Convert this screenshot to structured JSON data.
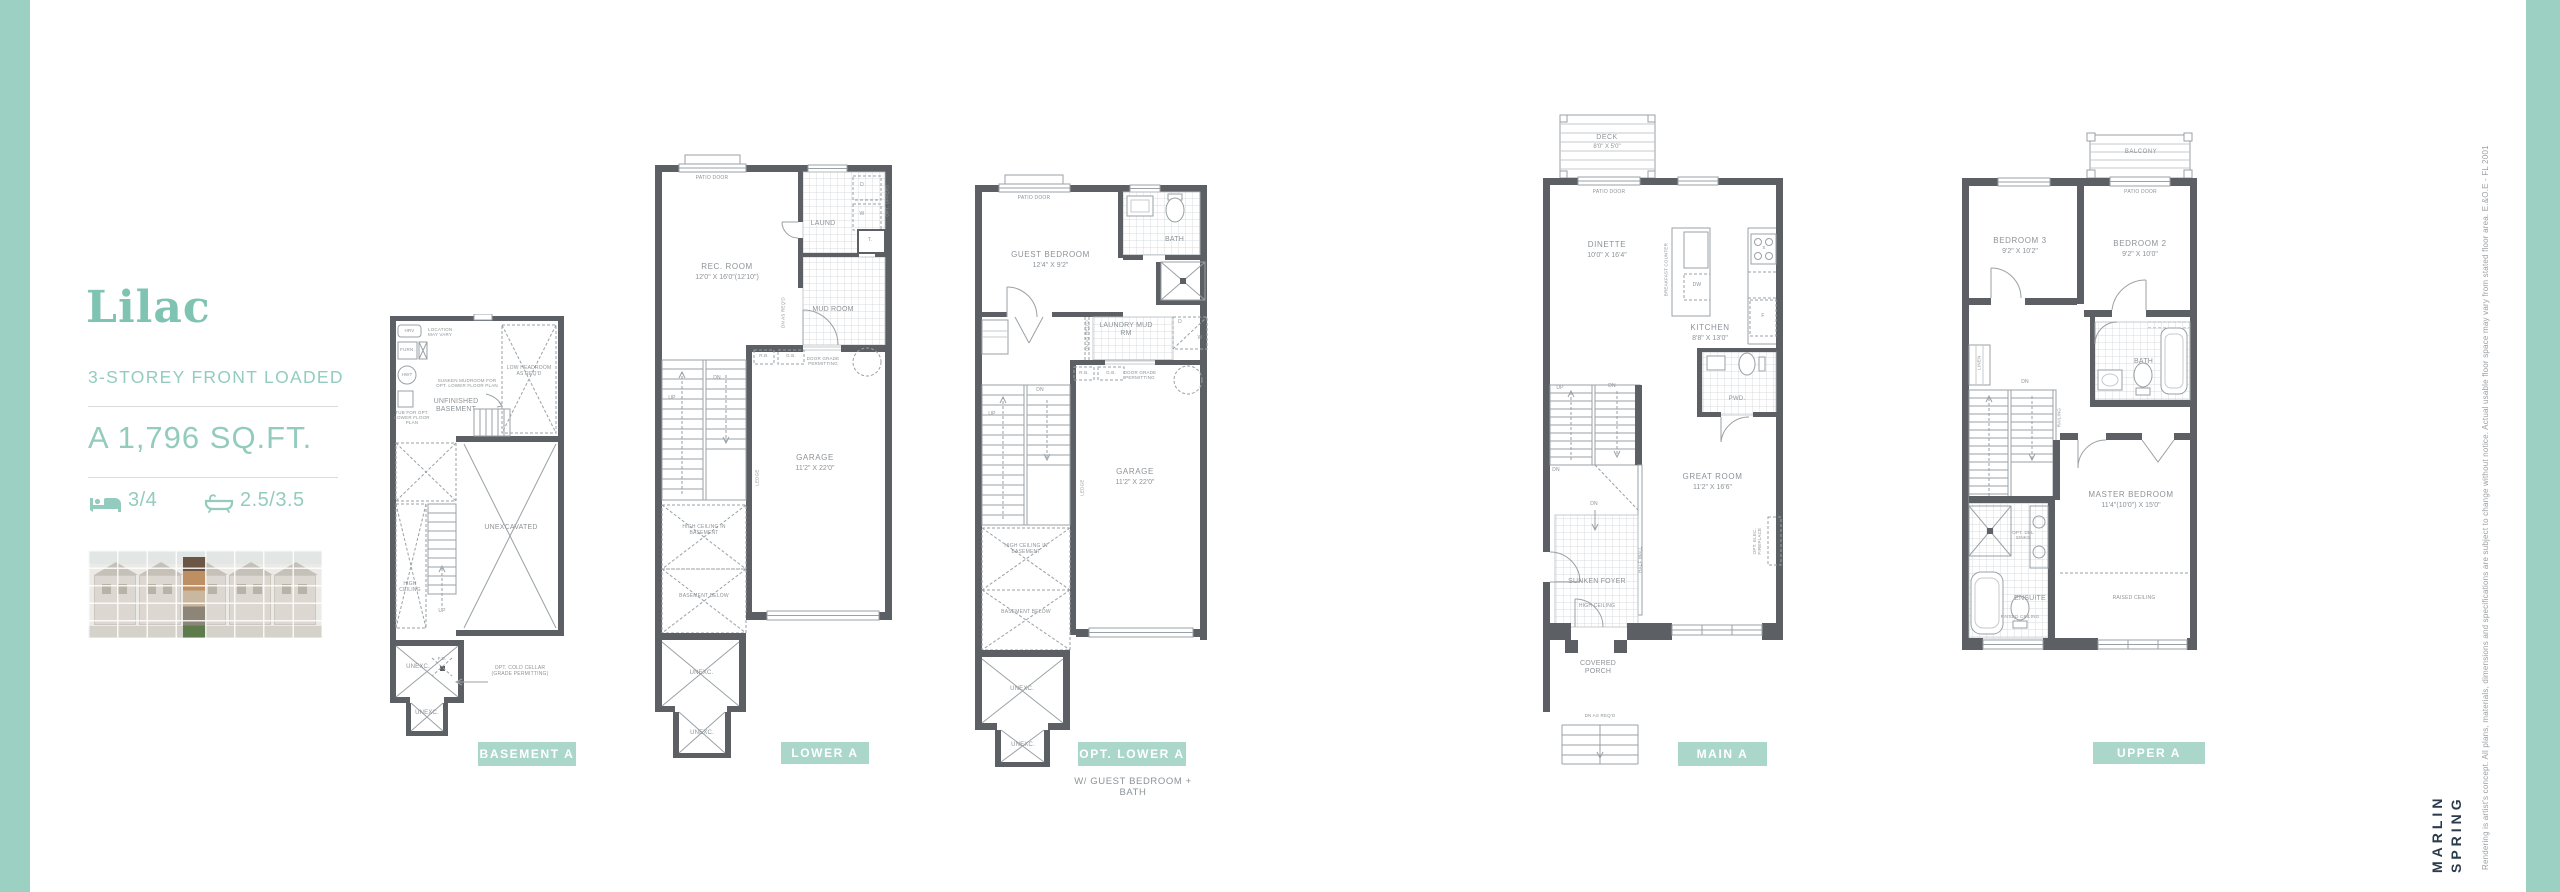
{
  "page": {
    "accent": "#9bd0c3",
    "tag_bg": "#abd7cb",
    "teal_text": "#93ccbe",
    "wall_color": "#5c6064",
    "line_color": "#9aa1a5"
  },
  "sidebar": {
    "title": "Lilac",
    "subtitle": "3-STOREY FRONT LOADED",
    "size_label": "A 1,796 SQ.FT.",
    "beds": "3/4",
    "baths": "2.5/3.5"
  },
  "plans": {
    "basement": {
      "tag": "BASEMENT A",
      "hrv": "HRV",
      "location_note": "LOCATION MAY VARY",
      "furn": "FURN.",
      "hwt": "HWT",
      "tub_note": "TUB FOR OPT. LOWER FLOOR PLAN",
      "sunken_note": "SUNKEN MUDROOM FOR OPT. LOWER FLOOR PLAN",
      "room": "UNFINISHED BASEMENT",
      "low_headroom": "LOW HEADROOM AS REQ'D",
      "unexcavated": "UNEXCAVATED",
      "up": "UP",
      "high_ceiling": "HIGH CEILING",
      "unexc_a": "UNEXC.",
      "fd": "F.D.",
      "cold_cellar": "OPT. COLD CELLAR (GRADE PERMITTING)",
      "unexc_b": "UNEXC."
    },
    "lower": {
      "tag": "LOWER A",
      "patio_door": "PATIO DOOR",
      "rec_room": "REC. ROOM",
      "rec_dims": "12'0\" x 16'0\"(12'10\")",
      "laund": "LAUND",
      "d": "D",
      "w": "W",
      "t": "T.",
      "opt_uppers": "OPT. UPPERS",
      "mud_room": "MUD ROOM",
      "dn_as_reqd": "DN AS REQ'D",
      "rb": "R.B.",
      "gb": "G.B.",
      "door_grade": "DOOR GRADE PERMITTING",
      "up": "UP",
      "dn": "DN",
      "ledge": "LEDGE",
      "garage": "GARAGE",
      "garage_dims": "11'2\" x 22'0\"",
      "high_ceiling": "HIGH CEILING IN BASEMENT",
      "basement_below": "BASEMENT BELOW",
      "unexc_a": "UNEXC.",
      "unexc_b": "UNEXC."
    },
    "optlower": {
      "tag": "OPT. LOWER A",
      "subtitle": "W/ GUEST BEDROOM + BATH",
      "patio_door": "PATIO DOOR",
      "guest_bedroom": "GUEST BEDROOM",
      "guest_dims": "12'4\" x 9'2\"",
      "bath": "BATH",
      "laundry_mud": "LAUNDRY MUD RM",
      "dn_as_reqd": "DN AS REQ'D",
      "d": "D",
      "w": "W",
      "rb": "R.B.",
      "gb": "G.B.",
      "door_grade": "DOOR GRADE PERMITTING",
      "up": "UP",
      "dn": "DN",
      "ledge": "LEDGE",
      "garage": "GARAGE",
      "garage_dims": "11'2\" x 22'0\"",
      "high_ceiling": "HIGH CEILING IN BASEMENT",
      "basement_below": "BASEMENT BELOW",
      "unexc_a": "UNEXC.",
      "unexc_b": "UNEXC."
    },
    "main": {
      "tag": "MAIN A",
      "deck": "DECK",
      "deck_dims": "8'0\" x 5'0\"",
      "patio_door": "PATIO DOOR",
      "dinette": "DINETTE",
      "dinette_dims": "10'0\" x 16'4\"",
      "breakfast_counter": "BREAKFAST COUNTER",
      "dw": "DW",
      "s": "S",
      "f": "F",
      "kitchen": "KITCHEN",
      "kitchen_dims": "8'8\" x 13'0\"",
      "pwd": "PWD.",
      "up": "UP",
      "dn": "DN",
      "great_room": "GREAT ROOM",
      "great_dims": "11'2\" x 16'6\"",
      "half_wall": "HALF WALL",
      "fireplace": "OPT. ELEC. FIREPLACE",
      "sunken_foyer": "SUNKEN FOYER",
      "high_ceiling": "HIGH CEILING",
      "covered_porch": "COVERED PORCH",
      "dn_as_reqd": "DN AS REQ'D"
    },
    "upper": {
      "tag": "UPPER A",
      "balcony": "BALCONY",
      "patio_door": "PATIO DOOR",
      "bedroom3": "BEDROOM 3",
      "bedroom3_dims": "9'2\" x 10'2\"",
      "bedroom2": "BEDROOM 2",
      "bedroom2_dims": "9'2\" x 10'0\"",
      "linen": "LINEN",
      "bath": "BATH",
      "dn": "DN",
      "railing": "RAILING",
      "master": "MASTER BEDROOM",
      "master_dims": "11'4\"(10'0\") x 15'0\"",
      "opt_dbl_sinks": "OPT. DBL SINKS",
      "ensuite": "ENSUITE",
      "raised_ceiling_ensuite": "RAISED CEILING",
      "raised_ceiling_master": "RAISED CEILING"
    }
  },
  "branding": {
    "logo_line1": "MARLIN",
    "logo_line2": "SPRING",
    "disclaimer": "Rendering is artist's concept. All plans, materials, dimensions and specifications are subject to change without notice. Actual usable floor space may vary from stated floor area. E.&O.E - FL 2001"
  }
}
